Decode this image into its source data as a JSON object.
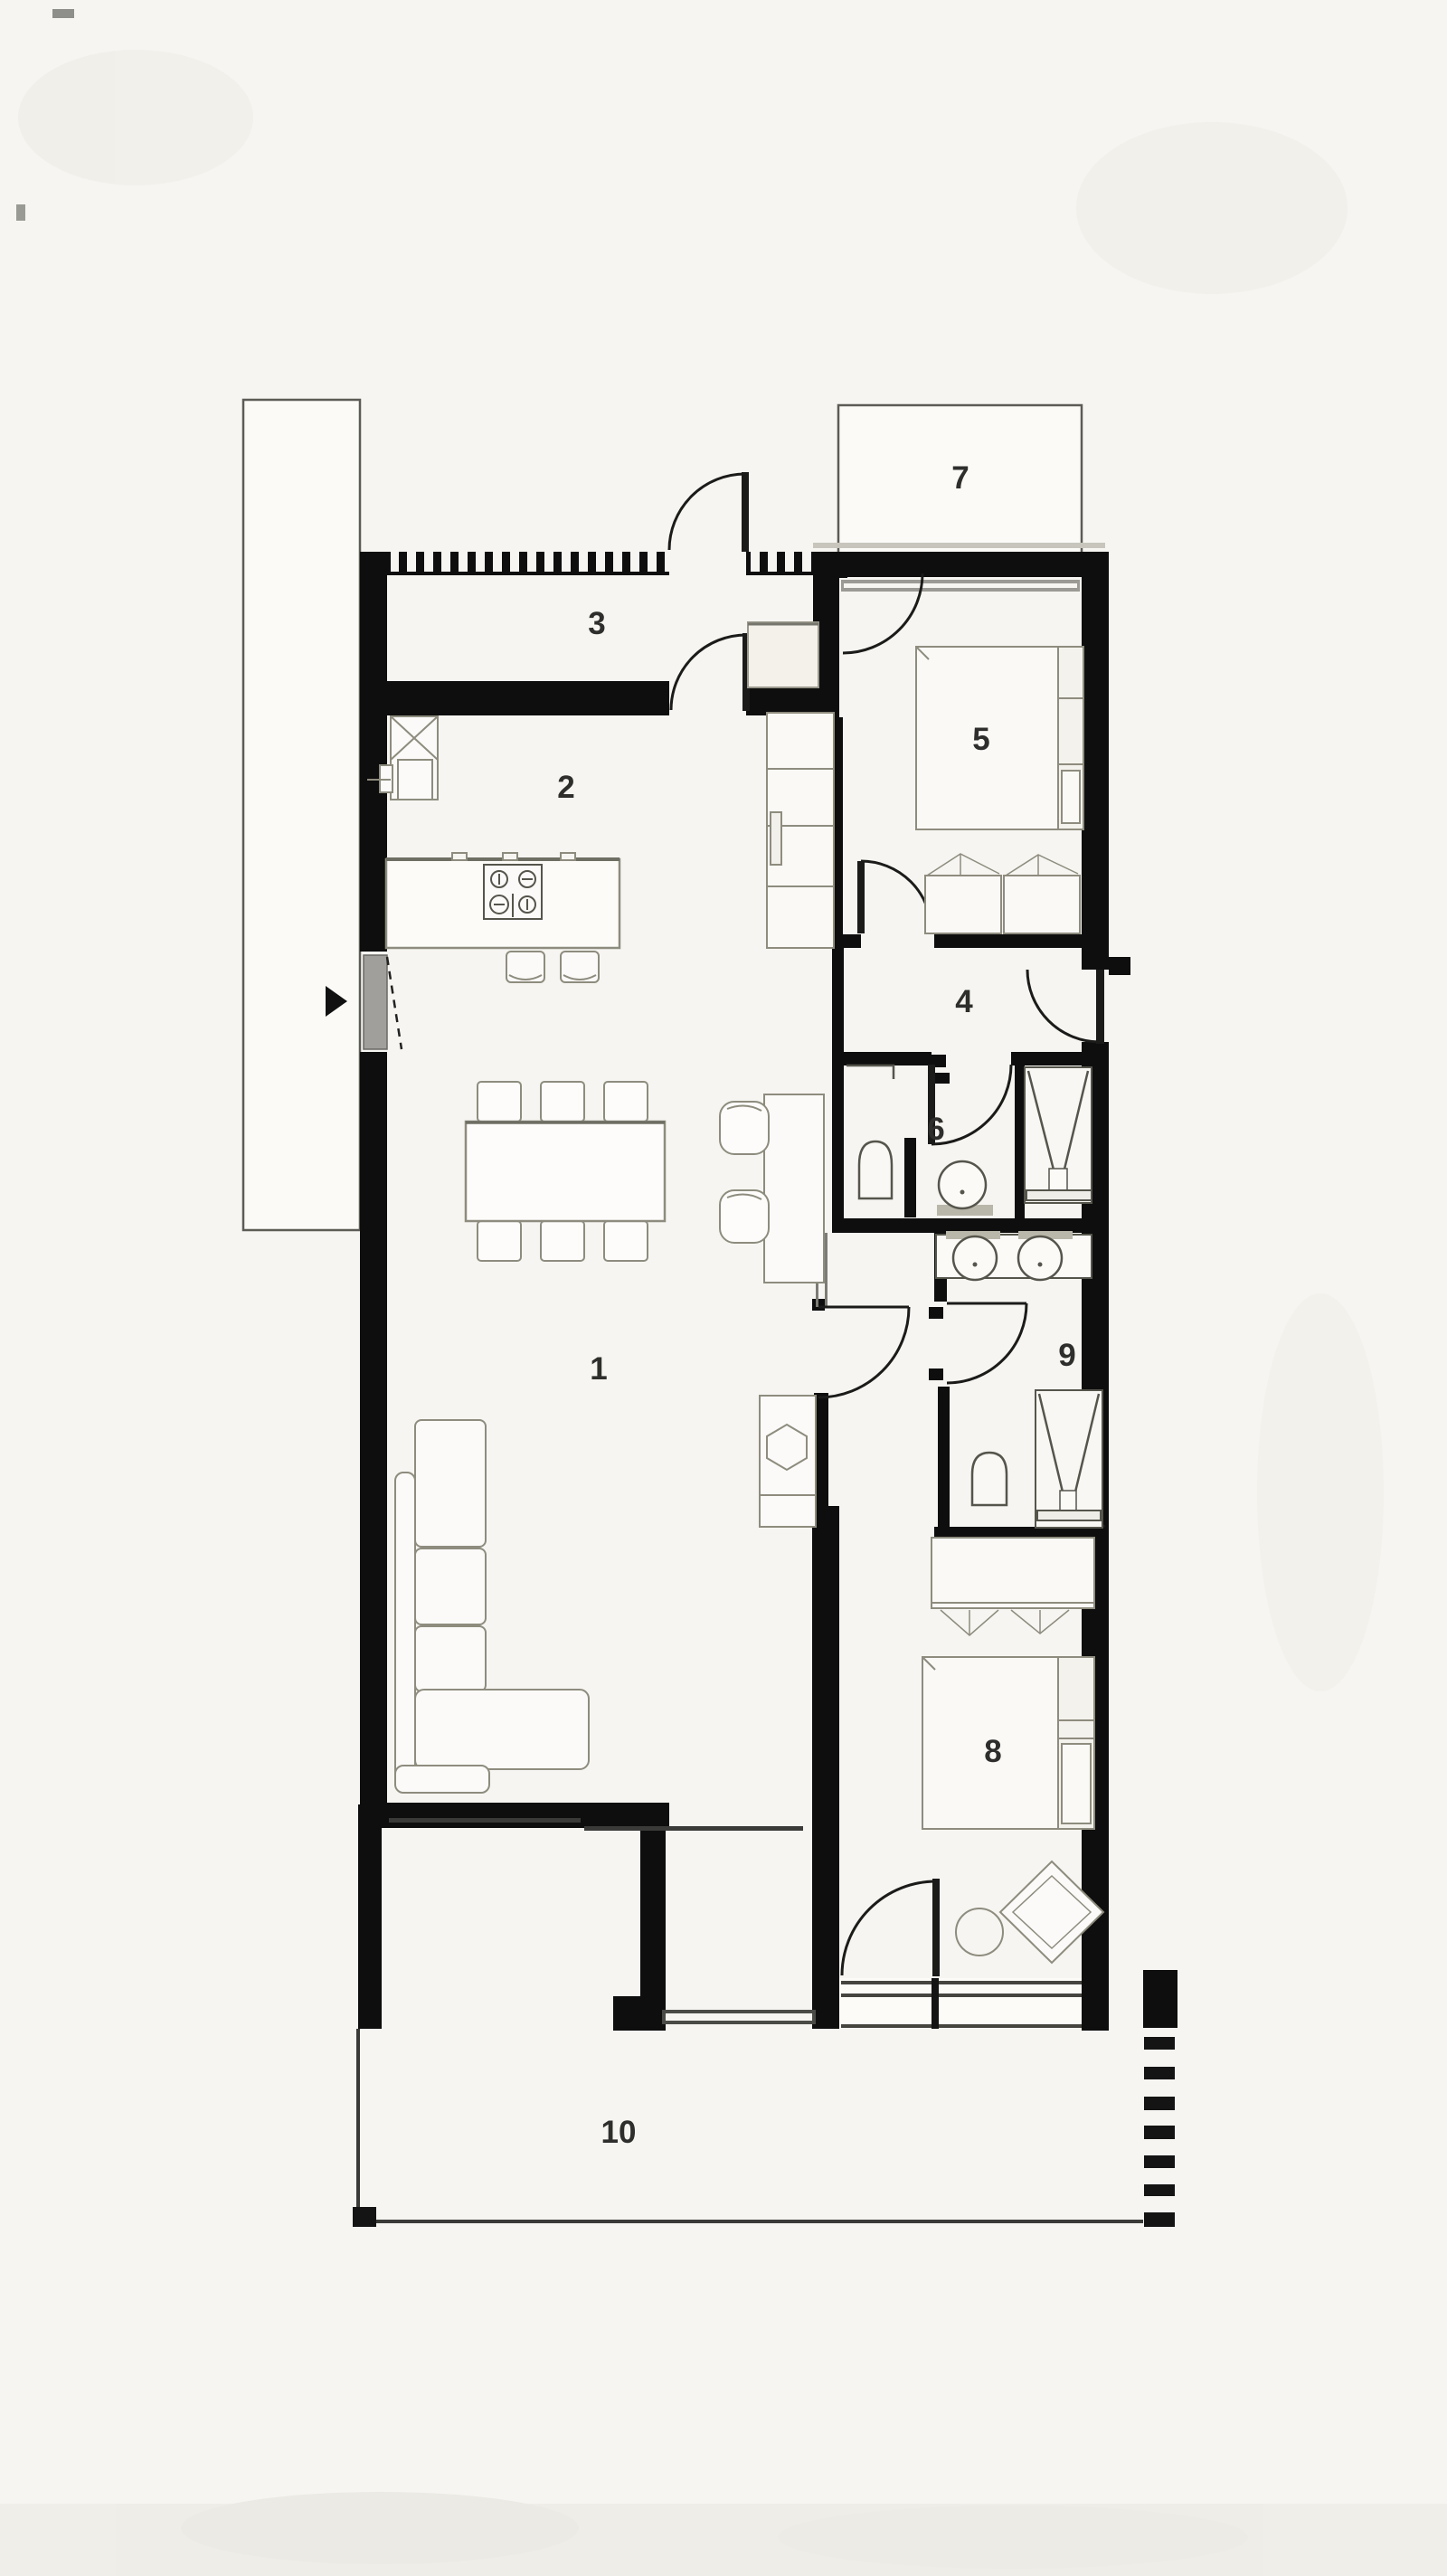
{
  "document": {
    "type": "architectural floor plan",
    "style": "monochrome top-view apartment plan with numbered rooms"
  },
  "palette": {
    "background": "#f6f5f1",
    "wall": "#0e0e0e",
    "furniture_line": "#8e8c7e",
    "fixture_line": "#56554c",
    "glass_line": "#45443f",
    "label": "#2e2e2c",
    "outdoor_outline": "#5c5b54"
  },
  "rooms": [
    {
      "number": "1",
      "name": "living-dining-room"
    },
    {
      "number": "2",
      "name": "kitchen"
    },
    {
      "number": "3",
      "name": "entry-hall"
    },
    {
      "number": "4",
      "name": "hallway"
    },
    {
      "number": "5",
      "name": "bedroom-1"
    },
    {
      "number": "6",
      "name": "bathroom"
    },
    {
      "number": "7",
      "name": "patio-top"
    },
    {
      "number": "8",
      "name": "bedroom-2"
    },
    {
      "number": "9",
      "name": "ensuite-bathroom"
    },
    {
      "number": "10",
      "name": "terrace"
    }
  ],
  "fixtures": {
    "entry_arrow": "entry-direction-arrow-icon",
    "doors": "hinged-door-quarter-arc-icon",
    "sliding_door": "sliding-glass-door-icon",
    "hatched_wall": "ventilated-facade-hatch-icon",
    "kitchen": [
      "kitchen-island-icon",
      "cooktop-4-burner-icon",
      "bar-stool-icon",
      "fridge-cross-icon",
      "tall-cabinet-run-icon"
    ],
    "living": [
      "l-shaped-sofa-icon",
      "dining-table-6-chairs-icon",
      "desk-with-2-chairs-icon",
      "cabinet-hexagon-basin-icon"
    ],
    "bedroom1": [
      "double-bed-icon",
      "headboard-shelf-icon",
      "storage-bench-icon"
    ],
    "bedroom2": [
      "double-bed-icon",
      "wardrobe-hangers-icon",
      "round-side-table-icon",
      "diamond-lounge-chair-icon"
    ],
    "bathroom": [
      "toilet-icon",
      "round-washbasin-icon",
      "shower-v-drain-icon",
      "wall-shelf-icon"
    ],
    "ensuite": [
      "double-washbasin-icon",
      "toilet-icon",
      "shower-v-drain-icon"
    ],
    "site": [
      "property-dash-line-icon",
      "terrace-outline-icon",
      "side-yard-outline-icon"
    ]
  }
}
